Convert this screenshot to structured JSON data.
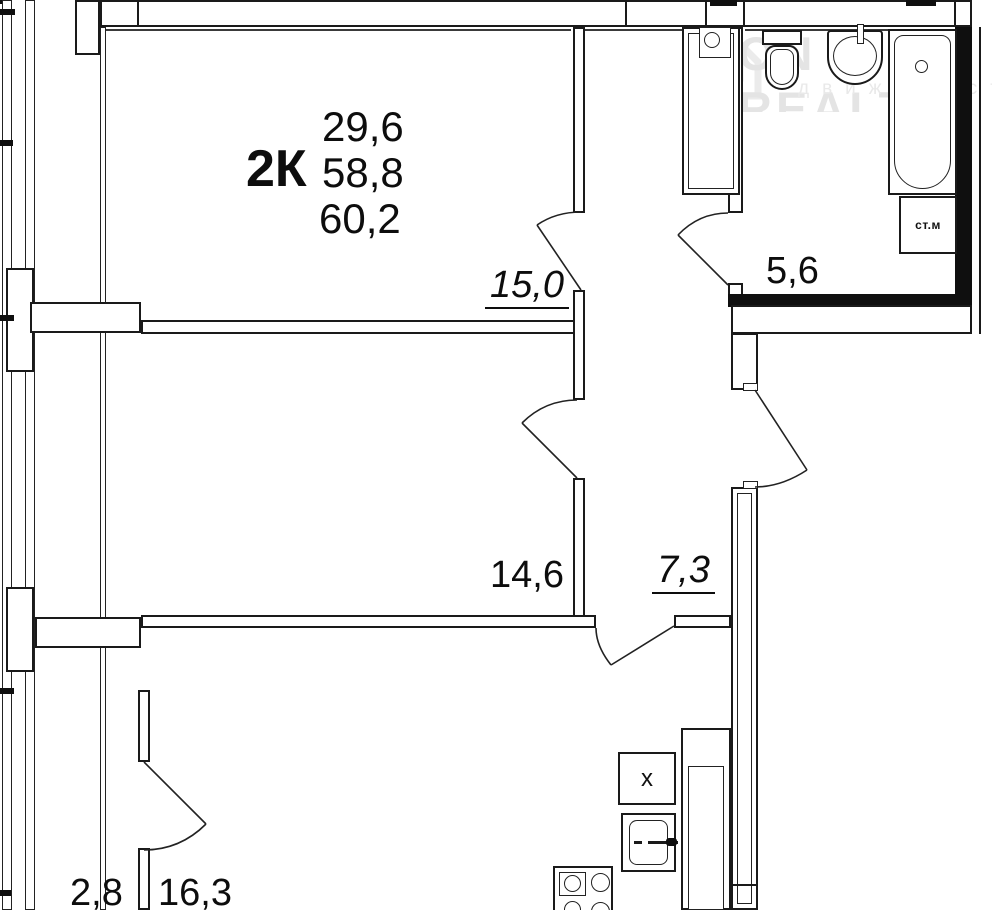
{
  "apartment_summary": {
    "type_label": "2К",
    "living_area": "29,6",
    "area": "58,8",
    "total_area": "60,2"
  },
  "room_labels": {
    "living_room": "15,0",
    "bedroom": "14,6",
    "hallway": "7,3",
    "bathroom": "5,6",
    "balcony": "2,8",
    "kitchen_living": "16,3"
  },
  "fixture_labels": {
    "washing_machine": "ст.м",
    "vent_box": "х"
  },
  "watermark": {
    "brand": "ON REALT",
    "subtitle": "движимост"
  },
  "colors": {
    "line": "#1a1a1a",
    "thick_wall": "#0f0f0f",
    "background": "#ffffff",
    "watermark": "#e4e4e4"
  }
}
